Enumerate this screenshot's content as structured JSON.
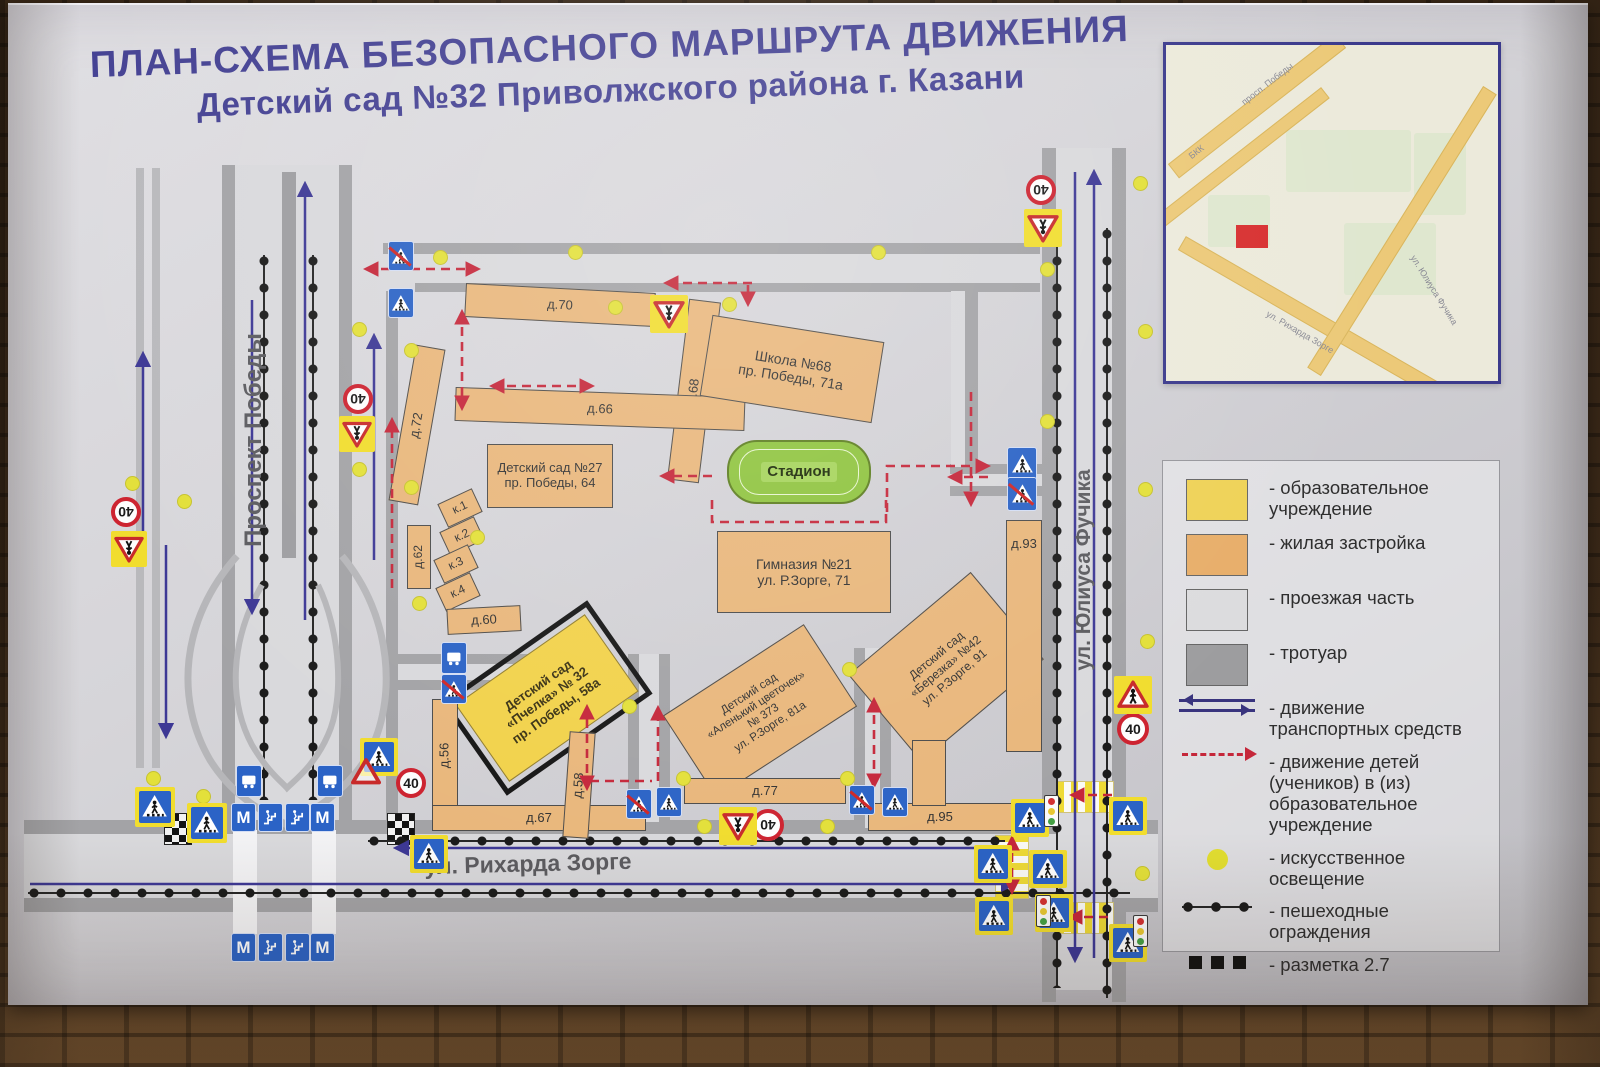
{
  "title": {
    "line1": "ПЛАН-СХЕМА БЕЗОПАСНОГО МАРШРУТА ДВИЖЕНИЯ",
    "line2": "Детский сад №32 Приволжского района г. Казани"
  },
  "streets": {
    "pobedy": "Проспект Победы",
    "zorge": "ул. Рихарда Зорге",
    "fuchika": "ул. Юлиуса Фучика"
  },
  "buildings": {
    "school68": "Школа №68\nпр. Победы, 71а",
    "kindergarten27": "Детский сад №27\nпр. Победы, 64",
    "gymnasium21": "Гимназия №21\nул. Р.Зорге, 71",
    "stadium": "Стадион",
    "pchelka": "Детский сад\n«Пчелка» № 32\nпр. Победы, 58а",
    "alenky": "Детский сад\n«Аленький цветочек»\n№ 373\nул. Р.Зорге, 81а",
    "berezka": "Детский сад\n«Березка» №42\nул. Р.Зорге, 91",
    "d70": "д.70",
    "d68": "д.68",
    "d66": "д.66",
    "d72": "д.72",
    "d62": "д.62",
    "d60": "д.60",
    "k1": "к.1",
    "k2": "к.2",
    "k3": "к.3",
    "k4": "к.4",
    "d56": "д.56",
    "d58": "д.58",
    "d67": "д.67",
    "d77": "д.77",
    "d93": "д.93",
    "d95": "д.95"
  },
  "signs": {
    "speed_limit": "40",
    "metro": "М"
  },
  "legend": {
    "items": [
      {
        "label": "- образовательное учреждение"
      },
      {
        "label": "- жилая застройка"
      },
      {
        "label": "- проезжая часть"
      },
      {
        "label": "- тротуар"
      },
      {
        "label": "- движение транспортных средств"
      },
      {
        "label": "- движение детей (учеников) в (из) образовательное учреждение"
      },
      {
        "label": "- искусственное освещение"
      },
      {
        "label": "- пешеходные ограждения"
      },
      {
        "label": "- разметка 2.7"
      }
    ]
  },
  "inset_map": {
    "labels": {
      "pobedy": "просп. Победы",
      "bkk": "БКК",
      "zorge": "ул. Рихарда Зорге",
      "fuchika": "ул. Юлиуса Фучика"
    }
  },
  "colors": {
    "education": "#f2d24b",
    "residential": "#e9b77c",
    "roadway": "#d9d9dc",
    "sidewalk": "#a3a3a6",
    "vehicle_route": "#3d3895",
    "children_route": "#c5273a",
    "lighting": "#e3e03a",
    "title_text": "#454293"
  }
}
